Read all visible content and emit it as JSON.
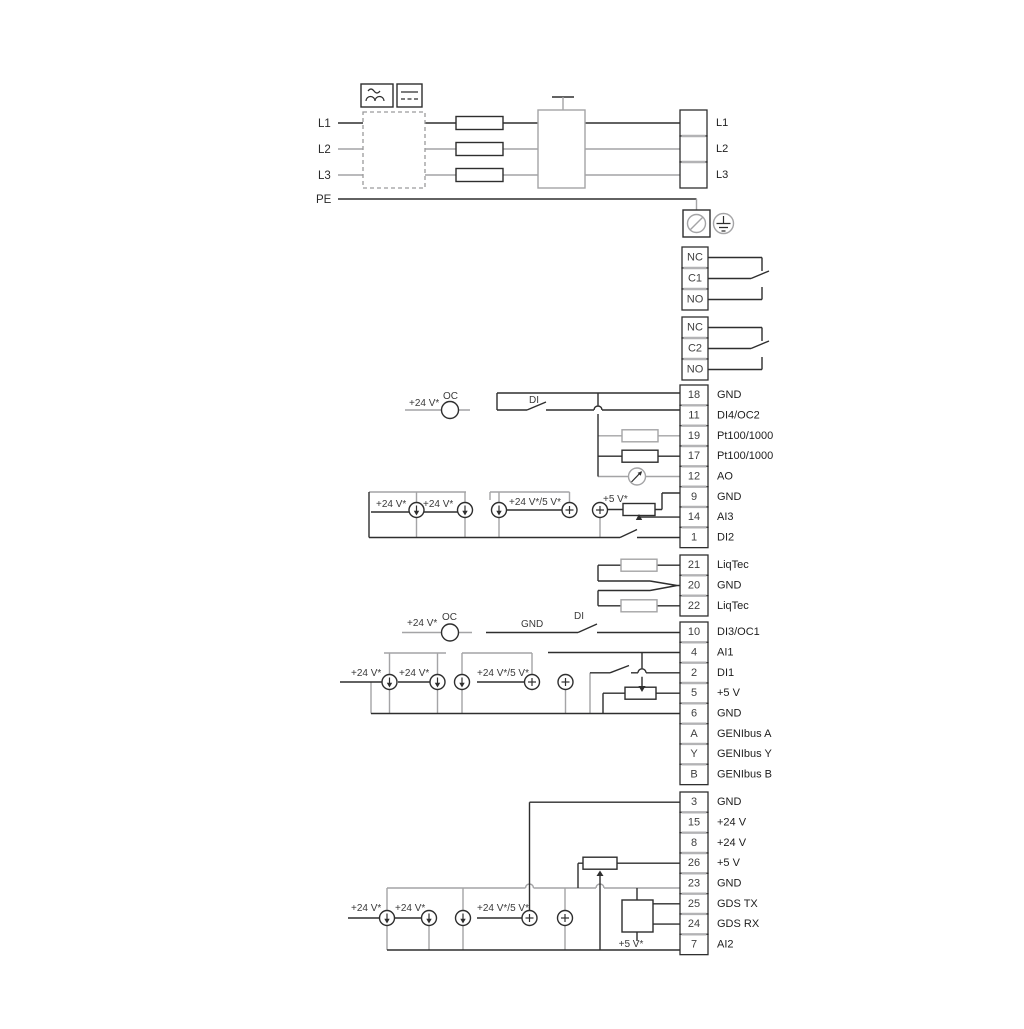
{
  "page": {
    "background": "#ffffff"
  },
  "colors": {
    "wire_dark": "#2e2e2e",
    "wire_gray": "#a4a4a6"
  },
  "ann": {
    "pin_l1": "L1",
    "pin_l2": "L2",
    "pin_l3": "L3",
    "pin_pe": "PE",
    "r18_v24": "+24 V*",
    "r18_oc": "OC",
    "r18_di": "DI",
    "r9_s1": "+24 V*",
    "r9_s2": "+24 V*",
    "r9_s3": "+24 V*/5 V*",
    "r9_s4": "+5 V*",
    "r10_v24": "+24 V*",
    "r10_oc": "OC",
    "r10_gnd": "GND",
    "r10_di": "DI",
    "r4_s1": "+24 V*",
    "r4_s2": "+24 V*",
    "r4_s3": "+24 V*/5 V*",
    "r7_s1": "+24 V*",
    "r7_s2": "+24 V*",
    "r7_s3": "+24 V*/5 V*",
    "r7_s4": "+5 V*"
  },
  "terminal_blocks": {
    "topright": {
      "rows": [
        {
          "num": "",
          "label": "L1"
        },
        {
          "num": "",
          "label": "L2"
        },
        {
          "num": "",
          "label": "L3"
        }
      ]
    },
    "relay1": {
      "rows": [
        {
          "num": "NC",
          "label": ""
        },
        {
          "num": "C1",
          "label": ""
        },
        {
          "num": "NO",
          "label": ""
        }
      ]
    },
    "relay2": {
      "rows": [
        {
          "num": "NC",
          "label": ""
        },
        {
          "num": "C2",
          "label": ""
        },
        {
          "num": "NO",
          "label": ""
        }
      ]
    },
    "main1": {
      "rows": [
        {
          "num": "18",
          "label": "GND"
        },
        {
          "num": "11",
          "label": "DI4/OC2"
        },
        {
          "num": "19",
          "label": "Pt100/1000"
        },
        {
          "num": "17",
          "label": "Pt100/1000"
        },
        {
          "num": "12",
          "label": "AO"
        },
        {
          "num": "9",
          "label": "GND"
        },
        {
          "num": "14",
          "label": "AI3"
        },
        {
          "num": "1",
          "label": "DI2"
        }
      ]
    },
    "liqtec": {
      "rows": [
        {
          "num": "21",
          "label": "LiqTec"
        },
        {
          "num": "20",
          "label": "GND"
        },
        {
          "num": "22",
          "label": "LiqTec"
        }
      ]
    },
    "main2": {
      "rows": [
        {
          "num": "10",
          "label": "DI3/OC1"
        },
        {
          "num": "4",
          "label": "AI1"
        },
        {
          "num": "2",
          "label": "DI1"
        },
        {
          "num": "5",
          "label": "+5 V"
        },
        {
          "num": "6",
          "label": "GND"
        },
        {
          "num": "A",
          "label": "GENIbus A"
        },
        {
          "num": "Y",
          "label": "GENIbus Y"
        },
        {
          "num": "B",
          "label": "GENIbus B"
        }
      ]
    },
    "main3": {
      "rows": [
        {
          "num": "3",
          "label": "GND"
        },
        {
          "num": "15",
          "label": "+24 V"
        },
        {
          "num": "8",
          "label": "+24 V"
        },
        {
          "num": "26",
          "label": "+5 V"
        },
        {
          "num": "23",
          "label": "GND"
        },
        {
          "num": "25",
          "label": "GDS TX"
        },
        {
          "num": "24",
          "label": "GDS RX"
        },
        {
          "num": "7",
          "label": "AI2"
        }
      ]
    }
  }
}
